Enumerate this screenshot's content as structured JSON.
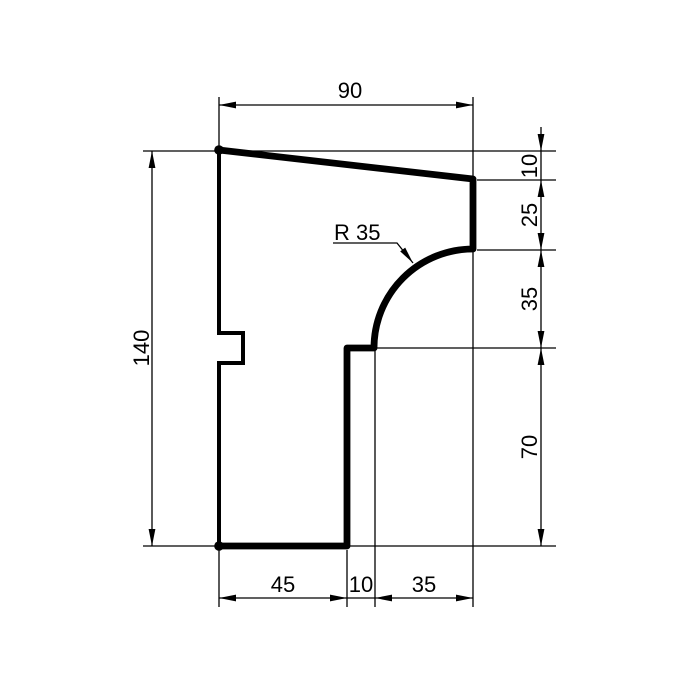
{
  "colors": {
    "ink": "#000000",
    "paper": "#ffffff"
  },
  "dims": {
    "top_width": "90",
    "left_height": "140",
    "right_top": "10",
    "right_upper": "25",
    "right_middle": "35",
    "right_lower": "70",
    "bottom_left": "45",
    "bottom_middle": "10",
    "bottom_right": "35"
  },
  "radius_label": "R 35"
}
